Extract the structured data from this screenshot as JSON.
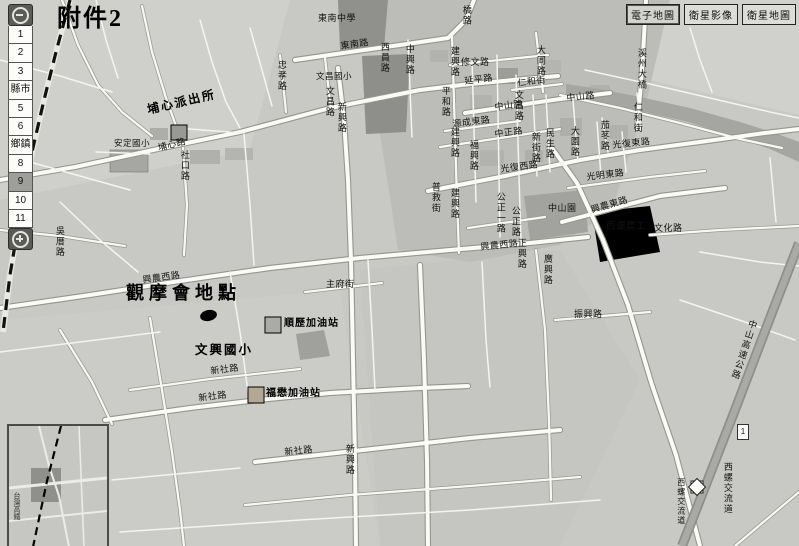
{
  "toolbar": {
    "buttons": [
      {
        "label": "電子地圖",
        "active": true
      },
      {
        "label": "衛星影像",
        "active": false
      },
      {
        "label": "衛星地圖",
        "active": false
      }
    ]
  },
  "zoom_control": {
    "levels": [
      "1",
      "2",
      "3",
      "縣市",
      "5",
      "6",
      "鄉鎮",
      "8",
      "9",
      "10",
      "11"
    ],
    "selected": "9",
    "zoom_out_icon": "magnifier-minus",
    "zoom_in_icon": "magnifier-plus"
  },
  "highway_shield": "1",
  "inset": {
    "hsr_label": "台灣高鐵"
  },
  "colors": {
    "map_bg": "#c8c8c4",
    "road": "#fafaf7",
    "urban_block": "#bcbcb8",
    "landmark_dark": "#90908c",
    "river": "#a5a5a1",
    "highway": "#a9a9a5",
    "hsr_line": "#111111",
    "annotation": "#000000"
  },
  "map_labels": [
    {
      "t": "附件2",
      "x": 57,
      "y": 6,
      "s": 24,
      "cls": "hand",
      "n": "attachment-label"
    },
    {
      "t": "埔心派出所",
      "x": 146,
      "y": 104,
      "s": 12,
      "r": -13,
      "cls": "hand",
      "n": "police-station-label"
    },
    {
      "t": "觀摩會地點",
      "x": 126,
      "y": 284,
      "s": 18,
      "cls": "hand big",
      "n": "event-location-label"
    },
    {
      "t": "文興國小",
      "x": 195,
      "y": 344,
      "s": 12.5,
      "cls": "hand",
      "n": "school-annotation-label"
    },
    {
      "t": "順歷加油站",
      "x": 284,
      "y": 318,
      "s": 10,
      "cls": "poi",
      "n": "gas-station-label"
    },
    {
      "t": "福懋加油站",
      "x": 266,
      "y": 388,
      "s": 10,
      "cls": "poi",
      "n": "gas-station-label"
    },
    {
      "t": "安定國小",
      "x": 114,
      "y": 139,
      "s": 8.5,
      "n": "school-label"
    },
    {
      "t": "東南中學",
      "x": 318,
      "y": 14,
      "n": "school-label"
    },
    {
      "t": "西螺農工",
      "x": 606,
      "y": 222,
      "s": 9.5,
      "n": "school-label"
    },
    {
      "t": "文昌國小",
      "x": 316,
      "y": 72,
      "s": 8.5,
      "n": "school-label"
    },
    {
      "t": "中山園",
      "x": 548,
      "y": 204,
      "n": "park-label"
    },
    {
      "t": "東南路",
      "x": 340,
      "y": 42,
      "r": -8
    },
    {
      "t": "橋路",
      "x": 461,
      "y": 5,
      "v": 1
    },
    {
      "t": "西員路",
      "x": 379,
      "y": 42,
      "v": 1
    },
    {
      "t": "忠孝路",
      "x": 276,
      "y": 60,
      "v": 1
    },
    {
      "t": "文昌路",
      "x": 324,
      "y": 86,
      "v": 1
    },
    {
      "t": "新興路",
      "x": 336,
      "y": 102,
      "v": 1
    },
    {
      "t": "中興路",
      "x": 404,
      "y": 44,
      "v": 1
    },
    {
      "t": "建興路",
      "x": 449,
      "y": 46,
      "v": 1
    },
    {
      "t": "修文路",
      "x": 461,
      "y": 58
    },
    {
      "t": "延平路",
      "x": 464,
      "y": 77,
      "r": -7
    },
    {
      "t": "大同路",
      "x": 535,
      "y": 45,
      "v": 1
    },
    {
      "t": "仁和街",
      "x": 517,
      "y": 79,
      "r": -7
    },
    {
      "t": "平和路",
      "x": 440,
      "y": 86,
      "v": 1
    },
    {
      "t": "文昌路",
      "x": 513,
      "y": 90,
      "v": 1
    },
    {
      "t": "中山路",
      "x": 494,
      "y": 103,
      "r": -7
    },
    {
      "t": "中山路",
      "x": 566,
      "y": 94,
      "r": -6
    },
    {
      "t": "源成東路",
      "x": 452,
      "y": 120,
      "r": -7
    },
    {
      "t": "中正路",
      "x": 494,
      "y": 130,
      "r": -7
    },
    {
      "t": "建興路",
      "x": 449,
      "y": 127,
      "v": 1
    },
    {
      "t": "新街路",
      "x": 530,
      "y": 132,
      "v": 1
    },
    {
      "t": "民生路",
      "x": 544,
      "y": 128,
      "v": 1
    },
    {
      "t": "大園路",
      "x": 569,
      "y": 126,
      "v": 1
    },
    {
      "t": "福興路",
      "x": 468,
      "y": 140,
      "v": 1
    },
    {
      "t": "光復東路",
      "x": 612,
      "y": 141,
      "r": -6
    },
    {
      "t": "光復西路",
      "x": 500,
      "y": 165,
      "r": -7
    },
    {
      "t": "光明東路",
      "x": 586,
      "y": 173,
      "r": -7
    },
    {
      "t": "普救街",
      "x": 430,
      "y": 182,
      "v": 1
    },
    {
      "t": "建興路",
      "x": 449,
      "y": 188,
      "v": 1
    },
    {
      "t": "公正一路",
      "x": 495,
      "y": 192,
      "v": 1
    },
    {
      "t": "公正路",
      "x": 510,
      "y": 206,
      "v": 1
    },
    {
      "t": "興農東路",
      "x": 590,
      "y": 206,
      "r": -16
    },
    {
      "t": "文化路",
      "x": 654,
      "y": 224
    },
    {
      "t": "正興路",
      "x": 516,
      "y": 238,
      "v": 1
    },
    {
      "t": "廣興路",
      "x": 542,
      "y": 254,
      "v": 1
    },
    {
      "t": "興農西路",
      "x": 480,
      "y": 243,
      "r": -6
    },
    {
      "t": "興農西路",
      "x": 142,
      "y": 276,
      "r": -8
    },
    {
      "t": "吳厝路",
      "x": 54,
      "y": 226,
      "v": 1
    },
    {
      "t": "主府街",
      "x": 326,
      "y": 280
    },
    {
      "t": "振興路",
      "x": 574,
      "y": 310
    },
    {
      "t": "新社路",
      "x": 210,
      "y": 367,
      "r": -7
    },
    {
      "t": "新社路",
      "x": 198,
      "y": 394,
      "r": -7
    },
    {
      "t": "新社路",
      "x": 284,
      "y": 448,
      "r": -6
    },
    {
      "t": "新興路",
      "x": 344,
      "y": 444,
      "v": 1
    },
    {
      "t": "溪州大橋",
      "x": 636,
      "y": 48,
      "v": 1,
      "n": "bridge-label"
    },
    {
      "t": "台灣高鐵",
      "x": 16,
      "y": 164,
      "v": 1,
      "n": "hsr-label"
    },
    {
      "t": "中山高速公路",
      "x": 748,
      "y": 318,
      "v": 1,
      "r": 18,
      "n": "freeway-label"
    },
    {
      "t": "西螺交流道",
      "x": 722,
      "y": 462,
      "v": 1,
      "n": "interchange-label"
    },
    {
      "t": "西螺交流道",
      "x": 676,
      "y": 478,
      "v": 1,
      "s": 8,
      "n": "interchange-label"
    },
    {
      "t": "仁和街",
      "x": 632,
      "y": 102,
      "v": 1
    },
    {
      "t": "茄苳路",
      "x": 599,
      "y": 120,
      "v": 1
    },
    {
      "t": "社口路",
      "x": 179,
      "y": 150,
      "v": 1
    },
    {
      "t": "埔心路",
      "x": 157,
      "y": 144,
      "r": -14
    }
  ]
}
